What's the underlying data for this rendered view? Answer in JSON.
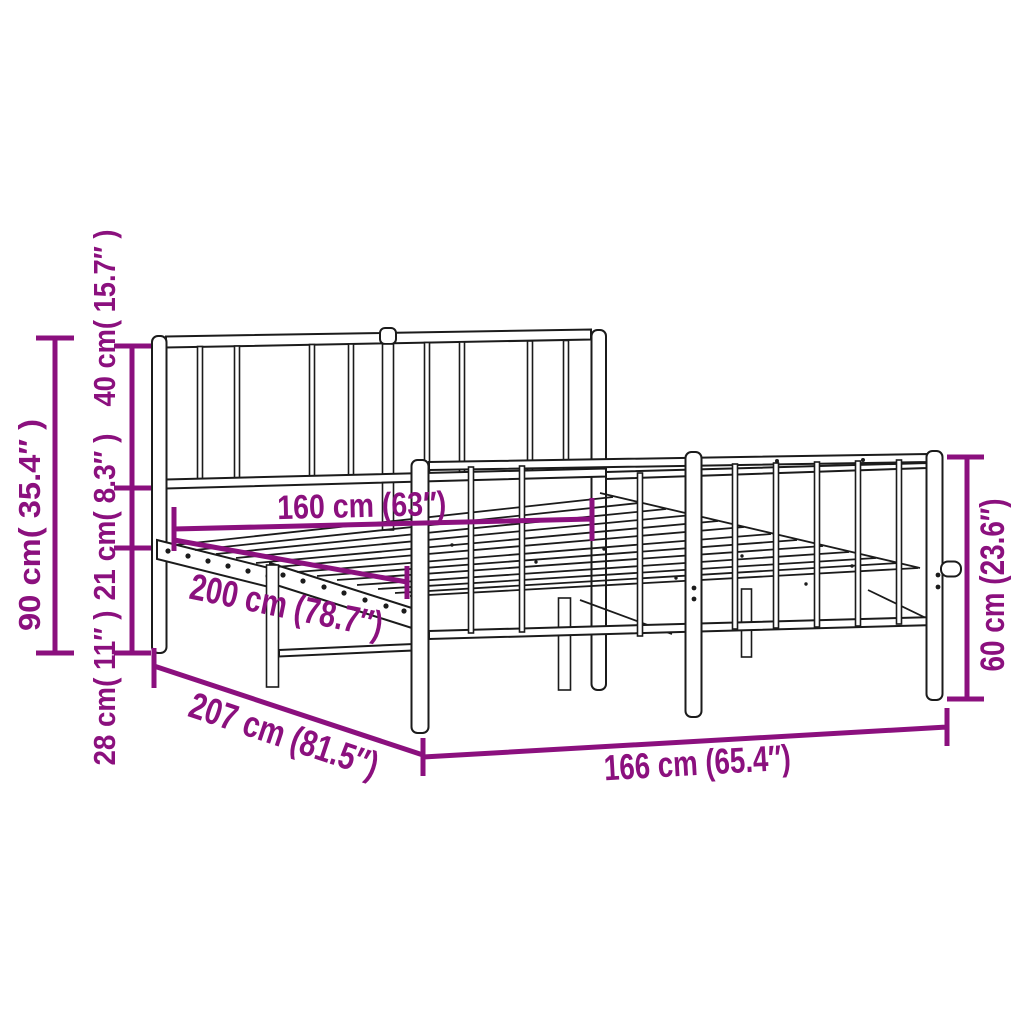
{
  "colors": {
    "accent": "#8b107e",
    "drawing_line": "#1b1b1b",
    "background": "#ffffff"
  },
  "diagram": {
    "kind": "product-dimension-line-drawing",
    "subject": "metal bed frame with headboard and footboard",
    "labels": {
      "total_height": "90 cm( 35.4″ )",
      "headboard_upper_height": "40 cm( 15.7″ )",
      "rail_to_deck_height": "21 cm( 8.3″ )",
      "deck_floor_height": "28 cm( 11″ )",
      "inner_width": "160 cm (63″)",
      "inner_length": "200 cm (78.7″)",
      "outer_length": "207 cm (81.5″)",
      "outer_width": "166 cm (65.4″)",
      "footboard_height": "60 cm (23.6″)"
    }
  }
}
